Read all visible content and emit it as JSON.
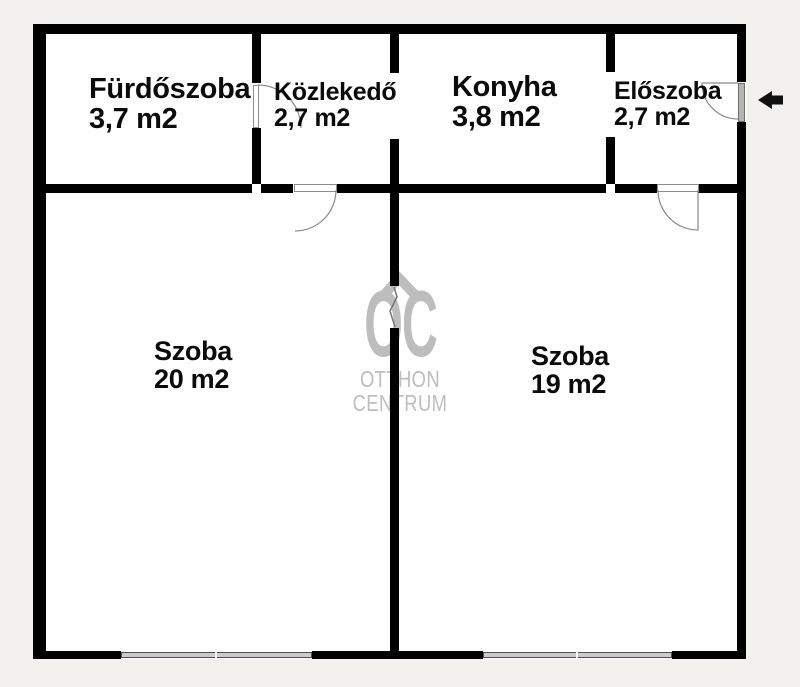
{
  "colors": {
    "background": "#f2f1ed",
    "interior": "#ffffff",
    "wall": "#000000",
    "watermark": "#bdbdbd",
    "window_fill": "#cbcbcb",
    "door_swing_line": "#8a8a8a",
    "entrance_arrow": "#111111"
  },
  "rooms": [
    {
      "name": "Fürdőszoba",
      "area": "3,7 m2"
    },
    {
      "name": "Közlekedő",
      "area": "2,7 m2"
    },
    {
      "name": "Konyha",
      "area": "3,8 m2"
    },
    {
      "name": "Előszoba",
      "area": "2,7 m2"
    },
    {
      "name": "Szoba",
      "area": "20 m2"
    },
    {
      "name": "Szoba",
      "area": "19 m2"
    }
  ],
  "watermark": {
    "logo": "OC",
    "line1": "OTTHON",
    "line2": "CENTRUM"
  }
}
